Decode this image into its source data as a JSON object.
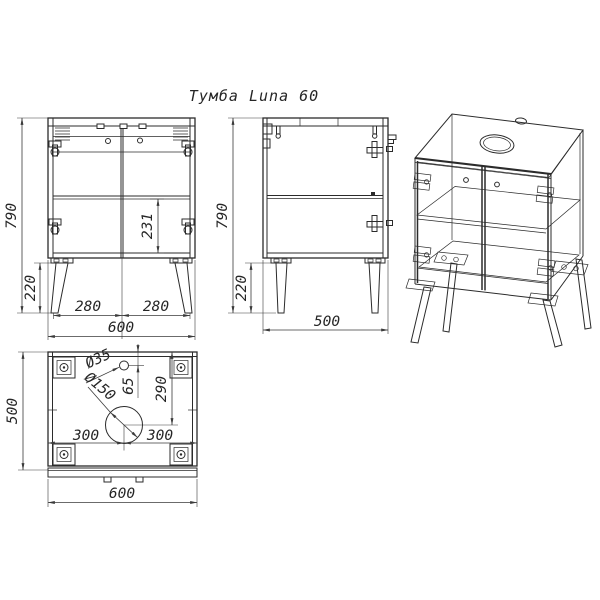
{
  "title": "Тумба Luna 60",
  "colors": {
    "ink": "#2b2b2b",
    "dim": "#3a3a3a",
    "background": "#ffffff"
  },
  "views": {
    "front": {
      "dims": {
        "height": "790",
        "leg_height": "220",
        "shelf_to_bottom": "231",
        "left_leg_span": "280",
        "right_leg_span": "280",
        "width": "600"
      }
    },
    "side": {
      "dims": {
        "height": "790",
        "leg_height": "220",
        "depth": "500"
      }
    },
    "top": {
      "dims": {
        "depth": "500",
        "width": "600",
        "small_hole_diameter": "Ø35",
        "large_hole_diameter": "Ø150",
        "small_hole_offset": "65",
        "large_hole_offset": "290",
        "center_to_left": "300",
        "center_to_right": "300"
      }
    }
  }
}
